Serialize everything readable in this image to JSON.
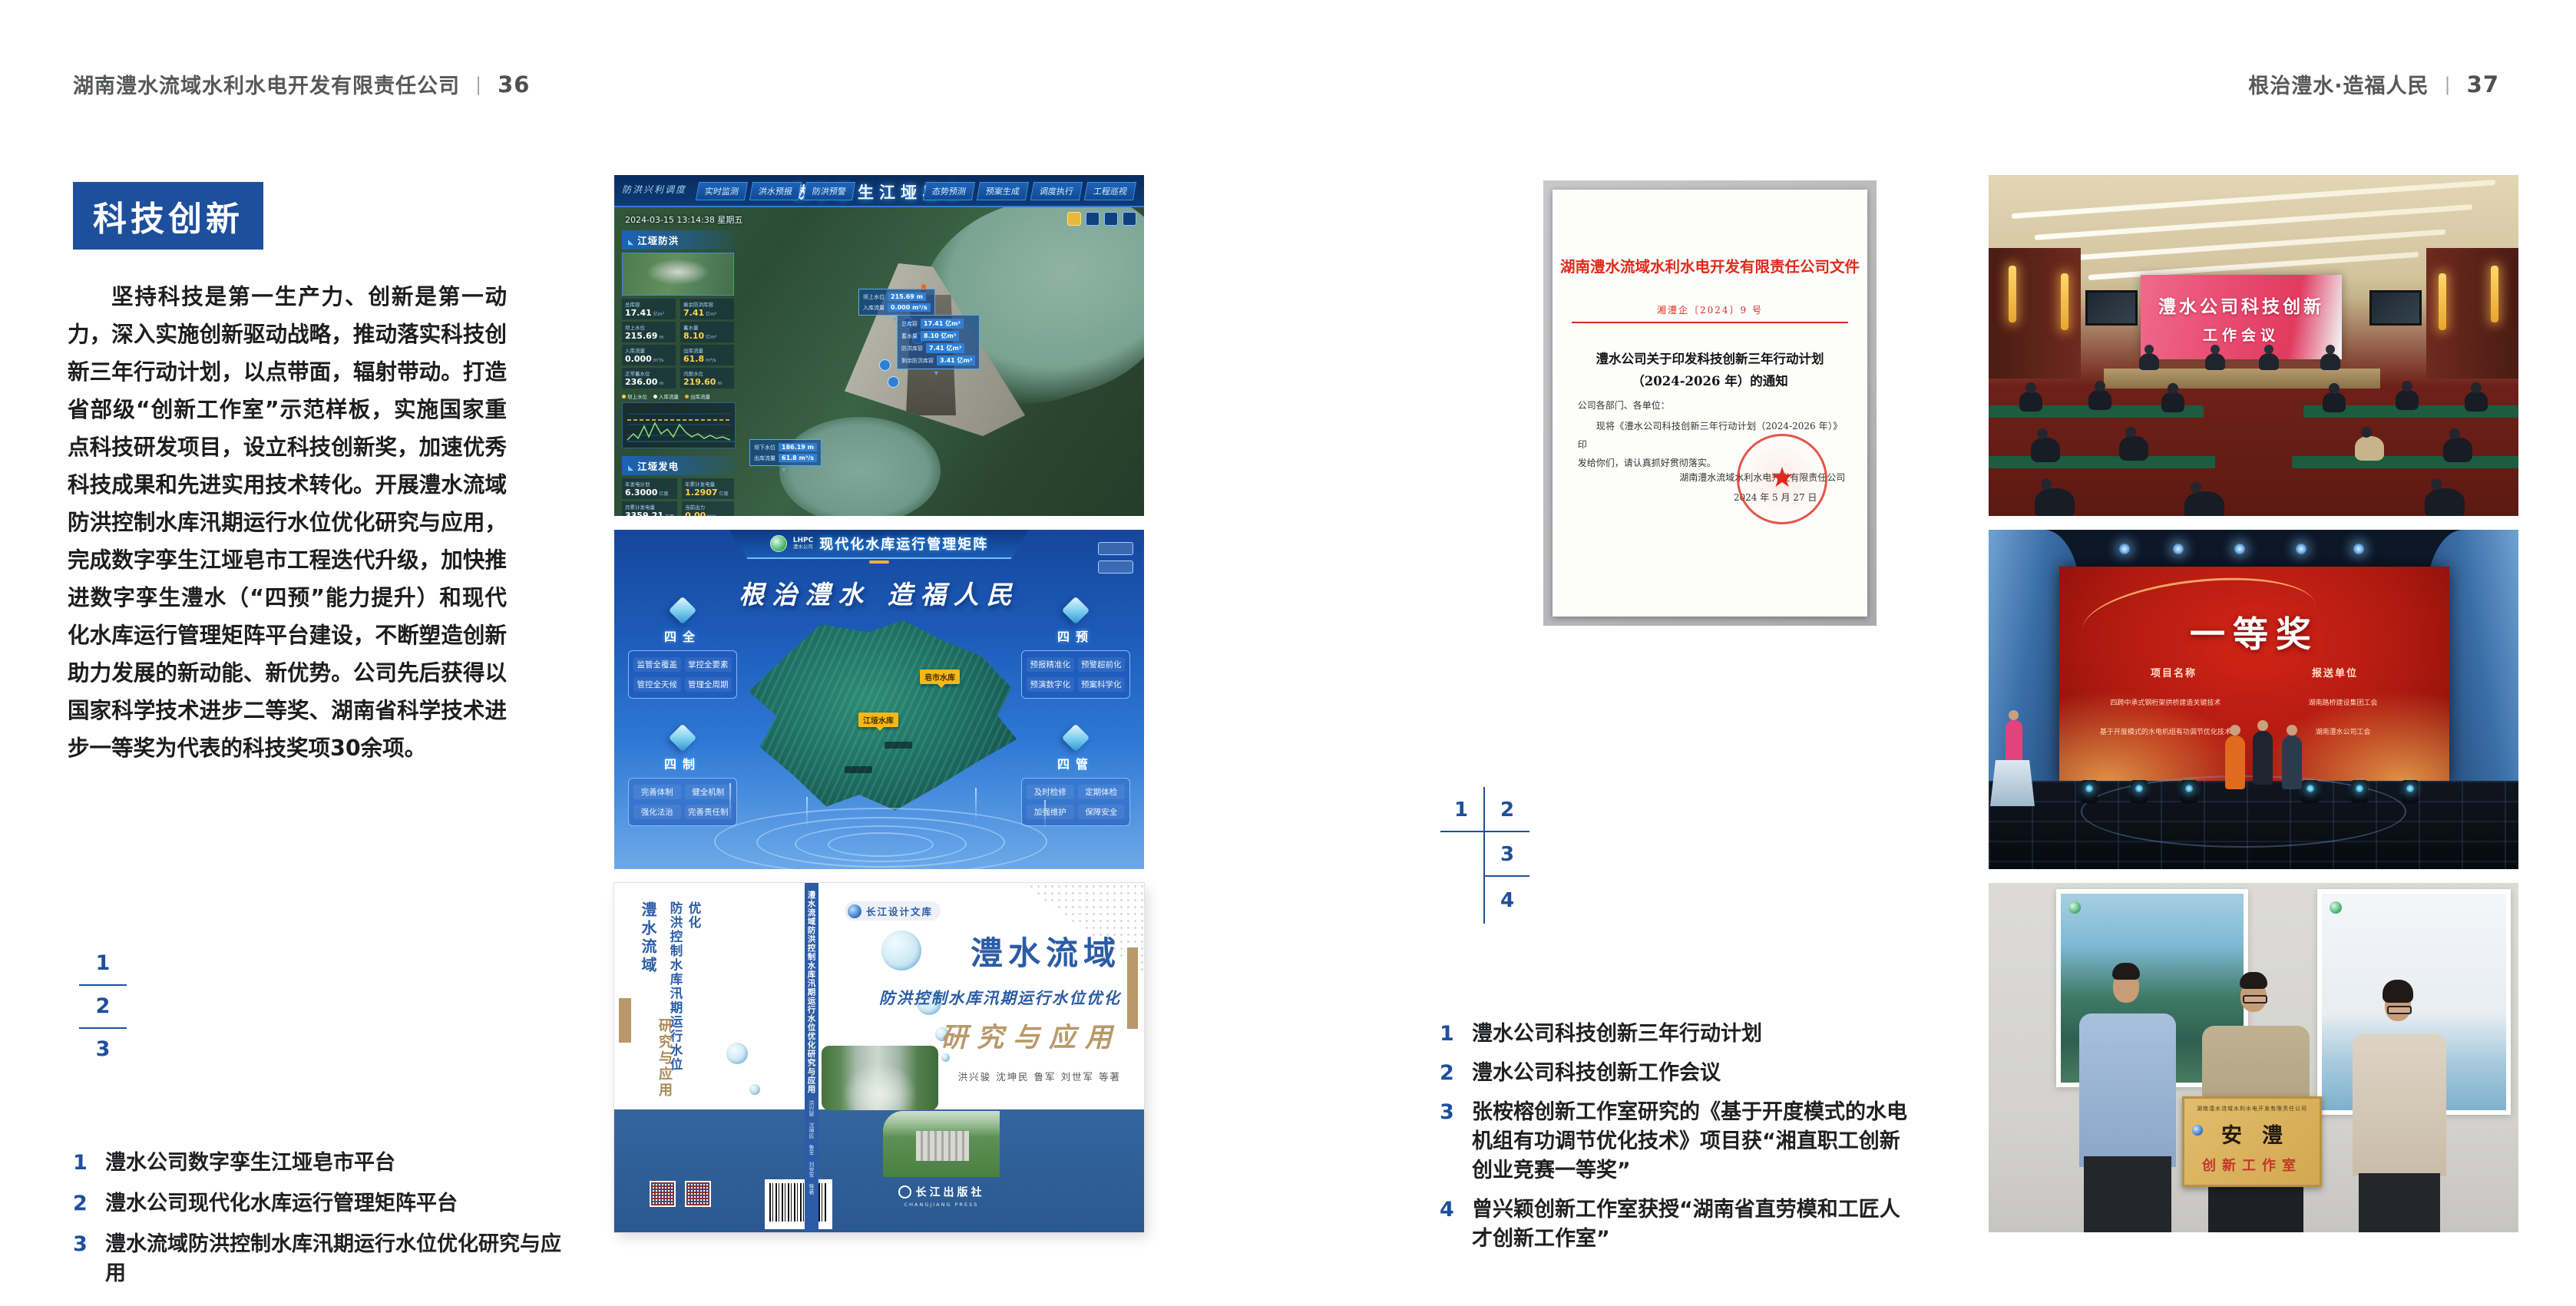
{
  "header": {
    "left_company": "湖南澧水流域水利水电开发有限责任公司",
    "left_page_no": "36",
    "right_slogan": "根治澧水·造福人民",
    "right_page_no": "37",
    "divider": "|"
  },
  "left": {
    "badge": "科技创新",
    "paragraph": "坚持科技是第一生产力、创新是第一动力，深入实施创新驱动战略，推动落实科技创新三年行动计划，以点带面，辐射带动。打造省部级“创新工作室”示范样板，实施国家重点科技研发项目，设立科技创新奖，加速优秀科技成果和先进实用技术转化。开展澧水流域防洪控制水库汛期运行水位优化研究与应用，完成数字孪生江垭皂市工程迭代升级，加快推进数字孪生澧水（“四预”能力提升）和现代化水库运行管理矩阵平台建设，不断塑造创新助力发展的新动能、新优势。公司先后获得以国家科学技术进步二等奖、湖南省科学技术进步一等奖为代表的科技奖项30余项。",
    "index": {
      "n1": "1",
      "n2": "2",
      "n3": "3"
    },
    "captions": [
      {
        "num": "1",
        "text": "澧水公司数字孪生江垭皂市平台"
      },
      {
        "num": "2",
        "text": "澧水公司现代化水库运行管理矩阵平台"
      },
      {
        "num": "3",
        "text": "澧水流域防洪控制水库汛期运行水位优化研究与应用"
      }
    ]
  },
  "dashboard": {
    "corner_label": "防洪兴利调度",
    "title": "数字孪生江垭皂市",
    "tabs_left": [
      "实时监测",
      "洪水预报",
      "防洪预警"
    ],
    "tabs_right": [
      "态势预测",
      "预案生成",
      "调度执行",
      "工程巡视"
    ],
    "timestamp": "2024-03-15 13:14:38 星期五",
    "panel_flood": {
      "title": "江垭防洪",
      "stats": [
        {
          "label": "总库容",
          "value": "17.41",
          "unit": "亿m³"
        },
        {
          "label": "剩余防洪库容",
          "value": "7.41",
          "unit": "亿m³"
        },
        {
          "label": "坝上水位",
          "value": "215.69",
          "unit": "m"
        },
        {
          "label": "蓄水量",
          "value": "8.10",
          "unit": "亿m³"
        },
        {
          "label": "入库流量",
          "value": "0.000",
          "unit": "m³/s"
        },
        {
          "label": "出库流量",
          "value": "61.8",
          "unit": "m³/s"
        },
        {
          "label": "正常蓄水位",
          "value": "236.00",
          "unit": "m"
        },
        {
          "label": "汛限水位",
          "value": "219.60",
          "unit": "m"
        }
      ],
      "legend": [
        "坝上水位",
        "入库流量",
        "出库流量"
      ]
    },
    "panel_power": {
      "title": "江垭发电",
      "stats": [
        {
          "label": "年发电计划",
          "value": "6.3000",
          "unit": "亿度"
        },
        {
          "label": "年累计发电量",
          "value": "1.2907",
          "unit": "亿度"
        },
        {
          "label": "月累计发电量",
          "value": "3359.21",
          "unit": "万度"
        },
        {
          "label": "当前出力",
          "value": "0.00",
          "unit": "MW"
        },
        {
          "label": "发电流量",
          "value": "0.00",
          "unit": "m³/s"
        },
        {
          "label": "弃水流量",
          "value": "0.00",
          "unit": "m³/s"
        }
      ],
      "gauge_values": [
        "0.00",
        "100.98",
        "0.00"
      ]
    },
    "callout_up": {
      "rows": [
        {
          "label": "坝上水位",
          "value": "215.69 m"
        },
        {
          "label": "入库流量",
          "value": "0.000 m³/s"
        }
      ]
    },
    "callout_right": {
      "rows": [
        {
          "label": "总库容",
          "value": "17.41 亿m³"
        },
        {
          "label": "蓄水量",
          "value": "8.10 亿m³"
        },
        {
          "label": "防洪库容",
          "value": "7.41 亿m³"
        },
        {
          "label": "剩余防洪库容",
          "value": "3.41 亿m³"
        }
      ]
    },
    "callout_down": {
      "rows": [
        {
          "label": "坝下水位",
          "value": "186.19 m"
        },
        {
          "label": "出库流量",
          "value": "61.8 m³/s"
        }
      ]
    }
  },
  "matrix": {
    "logo_top": "LHPC",
    "logo_sub": "澧水公司",
    "title": "现代化水库运行管理矩阵",
    "slogan": "根治澧水 造福人民",
    "quadrants": [
      {
        "name": "四全",
        "items": [
          "监管全覆盖",
          "掌控全要素",
          "管控全天候",
          "管理全周期"
        ]
      },
      {
        "name": "四预",
        "items": [
          "预报精准化",
          "预警超前化",
          "预演数字化",
          "预案科学化"
        ]
      },
      {
        "name": "四制",
        "items": [
          "完善体制",
          "健全机制",
          "强化法治",
          "完善责任制"
        ]
      },
      {
        "name": "四管",
        "items": [
          "及时检修",
          "定期体检",
          "加强维护",
          "保障安全"
        ]
      }
    ],
    "map_labels": [
      "皂市水库",
      "江垭水库"
    ]
  },
  "book": {
    "series": "长江设计文库",
    "title1": "澧水流域",
    "title2": "防洪控制水库汛期运行水位优化",
    "title3": "研究与应用",
    "authors": "洪兴骏  沈坤民  鲁军  刘世军  等著",
    "spine": "澧水流域防洪控制水库汛期运行水位优化研究与应用",
    "spine_authors": "洪兴骏 沈坤民 鲁军 刘世军 等著",
    "back_title1": "澧水流域",
    "back_title2": "防洪控制水库汛期运行水位优化",
    "back_title3": "研究与应用",
    "publisher": "长江出版社",
    "publisher_en": "CHANGJIANG PRESS"
  },
  "doc": {
    "header": "湖南澧水流域水利水电开发有限责任公司文件",
    "number": "湘澧企〔2024〕9 号",
    "title1": "澧水公司关于印发科技创新三年行动计划",
    "title2": "（2024-2026 年）的通知",
    "salutation": "公司各部门、各单位：",
    "body1": "现将《澧水公司科技创新三年行动计划（2024-2026 年）》印",
    "body2": "发给你们，请认真抓好贯彻落实。",
    "signer": "湖南澧水流域水利水电开发有限责任公司",
    "date": "2024 年 5 月 27 日"
  },
  "right": {
    "index": {
      "n1": "1",
      "n2": "2",
      "n3": "3",
      "n4": "4"
    },
    "captions": [
      {
        "num": "1",
        "text": "澧水公司科技创新三年行动计划"
      },
      {
        "num": "2",
        "text": "澧水公司科技创新工作会议"
      },
      {
        "num": "3",
        "text": "张桉榕创新工作室研究的《基于开度模式的水电机组有功调节优化技术》项目获“湘直职工创新创业竞赛一等奖”"
      },
      {
        "num": "4",
        "text": "曾兴颖创新工作室获授“湖南省直劳模和工匠人才创新工作室”"
      }
    ]
  },
  "meeting": {
    "screen1": "澧水公司科技创新",
    "screen2": "工作会议"
  },
  "award": {
    "title": "一等奖",
    "col1": "项目名称",
    "col2": "报送单位",
    "rows": [
      {
        "project": "四跨中承式钢桁架拱桥建造关键技术",
        "org": "湖南路桥建设集团工会"
      },
      {
        "project": "基于开度模式的水电机组有功调节优化技术",
        "org": "湖南澧水公司工会"
      }
    ]
  },
  "plaque": {
    "top": "湖南澧水流域水利水电开发有限责任公司",
    "main": "安澧",
    "sub": "创新工作室"
  }
}
